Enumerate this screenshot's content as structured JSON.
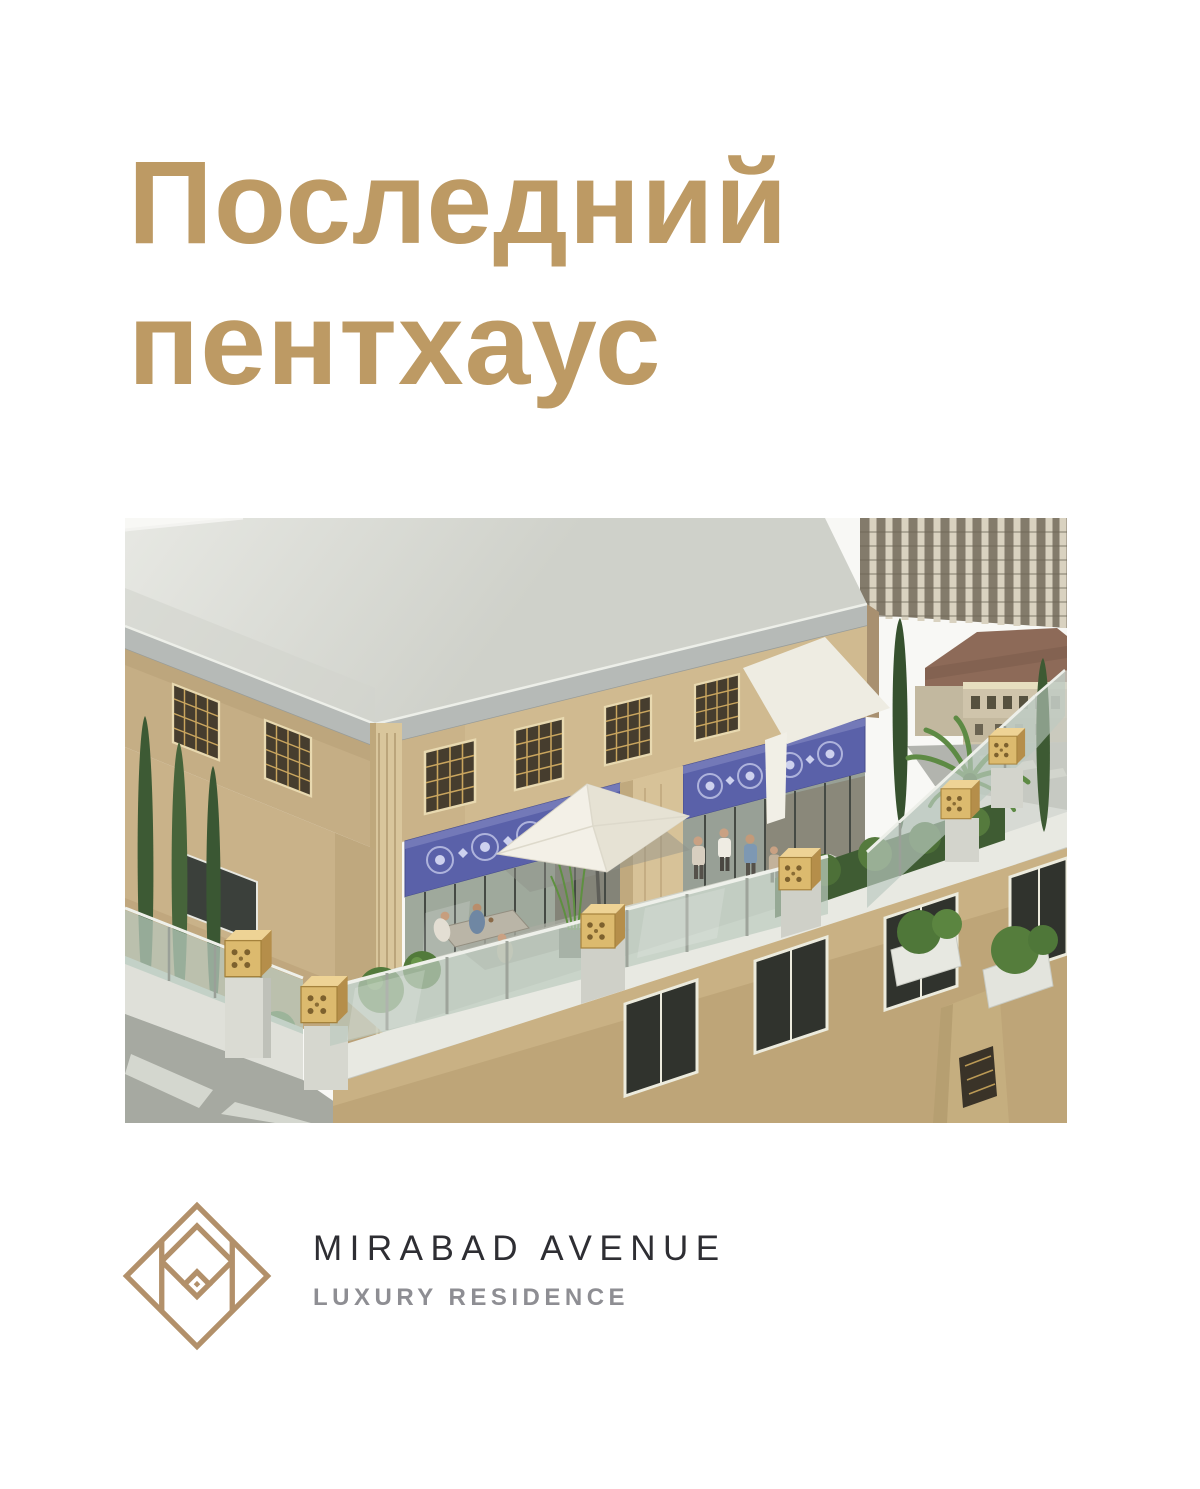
{
  "hero": {
    "title": "Последний пентхаус"
  },
  "brand": {
    "name": "MIRABAD AVENUE",
    "tagline": "LUXURY RESIDENCE",
    "logo_icon": "diamond-monogram-m-icon"
  },
  "image": {
    "alt": "Rooftop penthouse terrace 3D render"
  },
  "colors": {
    "accent-gold": "#bd9a64",
    "logo-gold": "#b2906a",
    "brand-ink": "#2e2e33",
    "brand-gray": "#8e8e93",
    "page-bg": "#ffffff"
  }
}
